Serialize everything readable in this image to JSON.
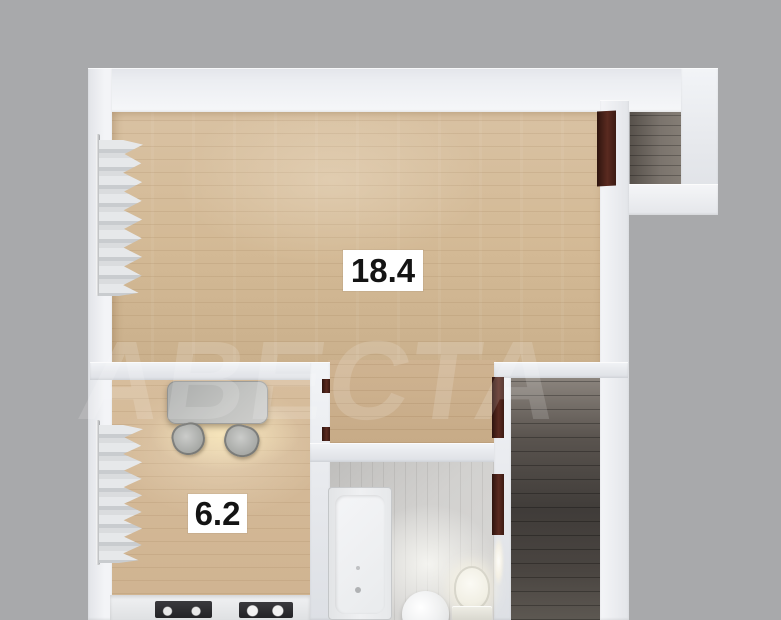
{
  "plan": {
    "type": "apartment-floor-plan-3d-render",
    "labels": {
      "living_area": "18.4",
      "kitchen_area": "6.2"
    },
    "watermark": {
      "text": "АВЕСТА"
    },
    "colors": {
      "background": "#a8a9ab",
      "wall": "#eceef2",
      "wood_floor": "#d6bd9c",
      "passage_floor": "#cbb08c",
      "corridor_floor": "#4e4a46",
      "niche_floor": "#6e6761",
      "bathroom_floor": "#d0cfcd",
      "door_wood": "#4a2218",
      "label_background": "#ffffff",
      "label_text": "#141414"
    },
    "rooms": [
      {
        "name": "living-room",
        "area": "18.4",
        "floor": "light-wood"
      },
      {
        "name": "kitchen",
        "area": "6.2",
        "floor": "light-wood"
      },
      {
        "name": "bathroom",
        "floor": "gray-tile"
      },
      {
        "name": "corridor",
        "floor": "dark-wood"
      },
      {
        "name": "entry-niche",
        "floor": "dark-wood"
      }
    ],
    "fixtures": [
      "curtain",
      "curtain",
      "dining-table",
      "chair",
      "chair",
      "kitchen-counter",
      "stove",
      "sink-unit",
      "bathtub",
      "pedestal-sink",
      "toilet",
      "open-door",
      "door-frame",
      "door-frame"
    ]
  }
}
